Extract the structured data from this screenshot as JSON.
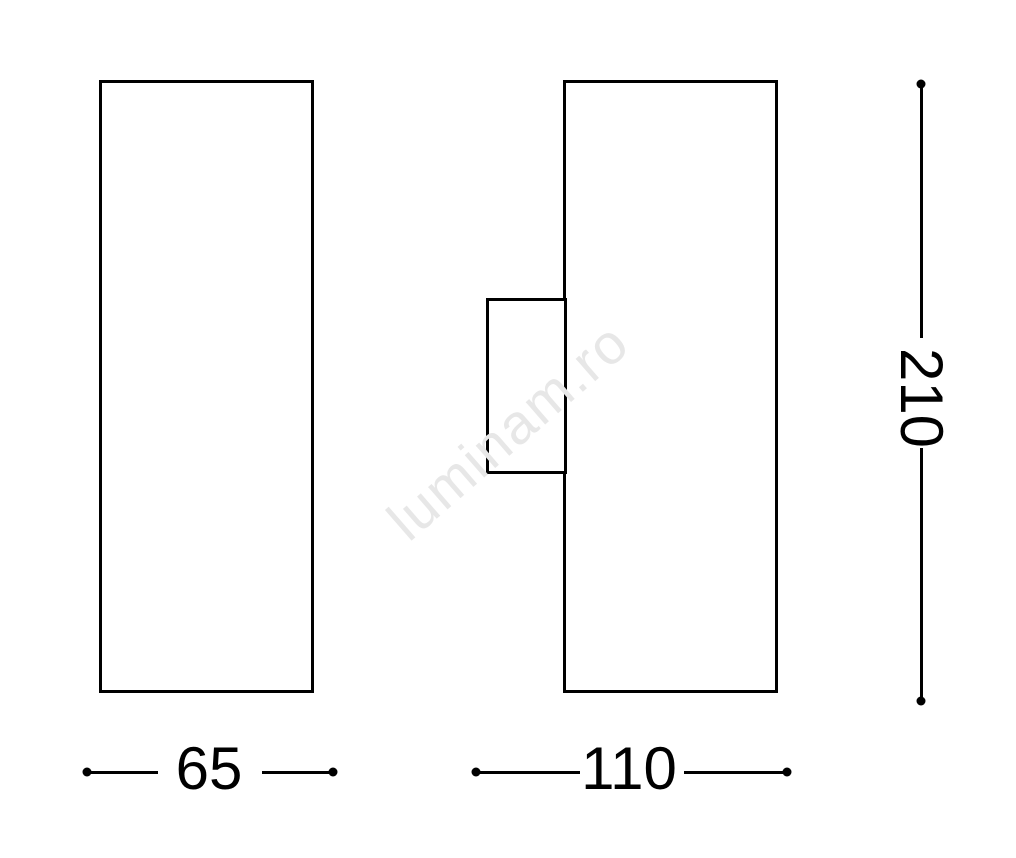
{
  "dimensions": {
    "front_width": "65",
    "side_depth": "110",
    "height": "210"
  },
  "watermark": {
    "text": "luminam.ro"
  },
  "colors": {
    "line": "#000000",
    "background": "#ffffff",
    "watermark": "#e7e7e7"
  }
}
